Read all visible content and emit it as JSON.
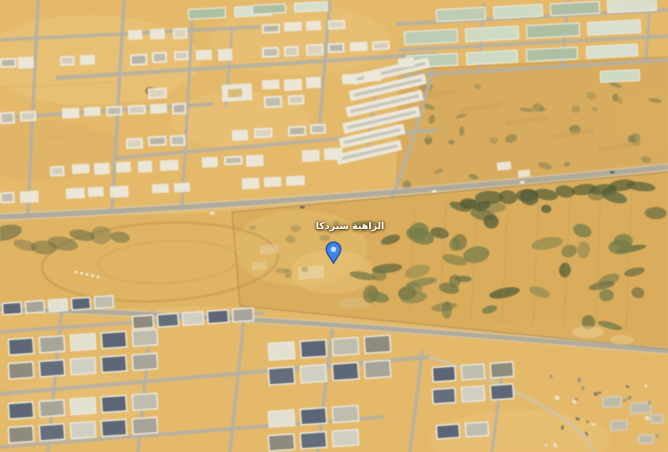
{
  "map": {
    "view_type": "oblique-aerial-satellite",
    "scene": "desert residential district with walled farm plot, warehouse rows, villa blocks and dirt track",
    "label": {
      "text": "الزاهية سيردكا",
      "color": "#ffffff"
    },
    "pin": {
      "kind": "place-marker",
      "fill": "#3f83e8",
      "stroke": "#1d4fa5",
      "inner": "#bfdcf9"
    },
    "palette": {
      "sand": "#e8b864",
      "sand_light": "#f3cd82",
      "sand_dark": "#d9a44f",
      "field_tan": "#dcab55",
      "track_tan": "#e3b25c",
      "scrub_tan": "#d9a855",
      "road": "#aaa89e",
      "road_light": "#d7d4c9",
      "building": "#eceadf",
      "roof_gray": "#a9a79d",
      "roof_navy": "#47536a",
      "warehouse_green": "#b6cbb0",
      "vegetation": "#566036",
      "track_line": "#c89c4f"
    }
  }
}
